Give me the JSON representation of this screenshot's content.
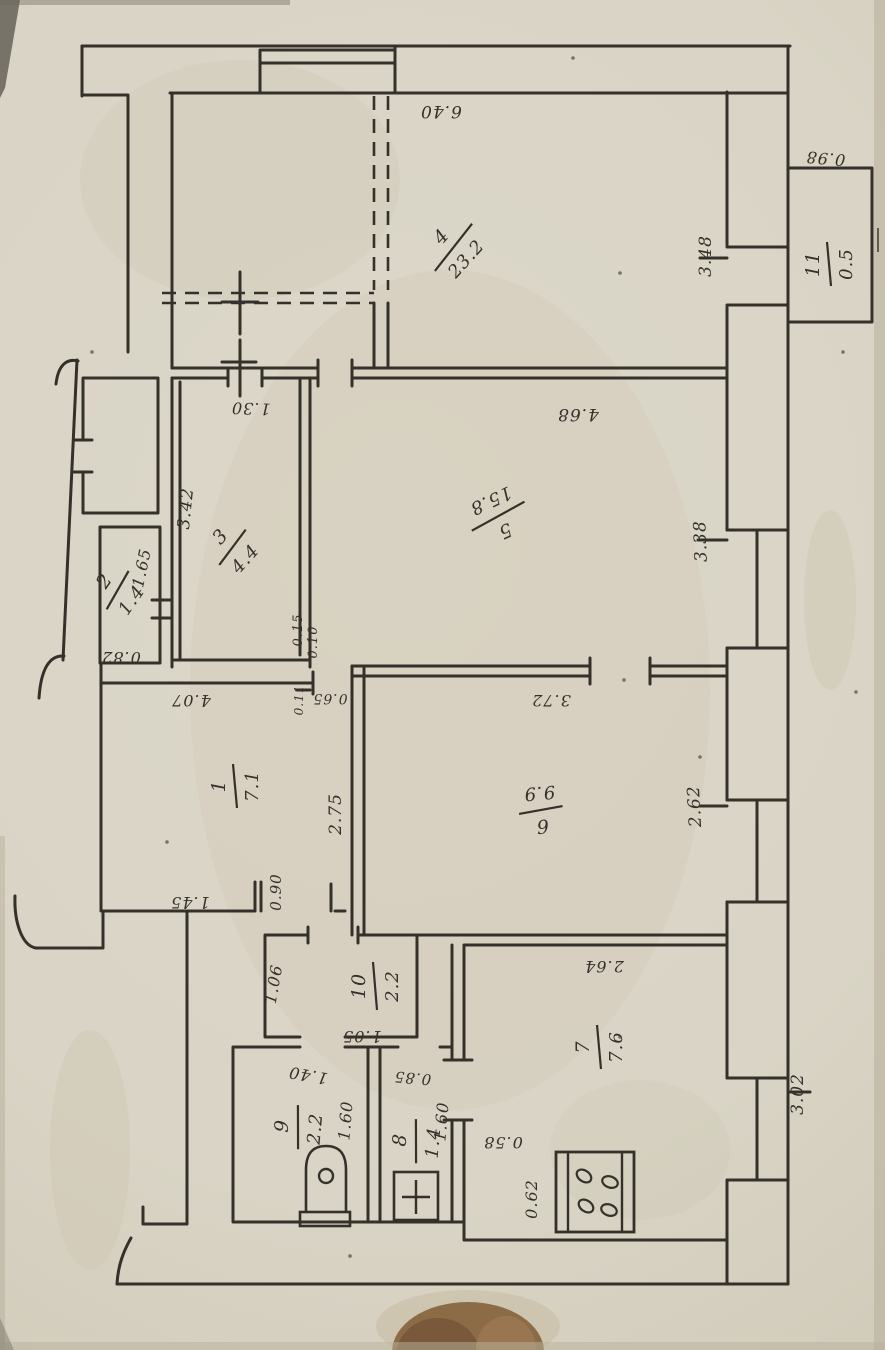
{
  "photo": {
    "kind": "scanned hand-drawn apartment floor plan, rotated",
    "language": "numeric labels only"
  },
  "colors": {
    "paper": "#d9d4c5",
    "paper_edge": "#c6bfab",
    "ink": "#34312b",
    "stain": "#cfc8b4",
    "finger_dark": "#77573a",
    "finger_mid": "#8c6c46",
    "finger_light": "#9a7850"
  },
  "rooms": [
    {
      "number": "1",
      "area": "7.1",
      "x": 233,
      "y": 786,
      "rot": -90,
      "len": 22
    },
    {
      "number": "2",
      "area": "1.4",
      "x": 116,
      "y": 589,
      "rot": -55,
      "len": 22
    },
    {
      "number": "3",
      "area": "4.4",
      "x": 231,
      "y": 546,
      "rot": -48,
      "len": 22
    },
    {
      "number": "4",
      "area": "23.2",
      "x": 452,
      "y": 246,
      "rot": -48,
      "len": 30
    },
    {
      "number": "5",
      "area": "15.8",
      "x": 499,
      "y": 518,
      "rot": 155,
      "len": 30
    },
    {
      "number": "6",
      "area": "9.9",
      "x": 541,
      "y": 812,
      "rot": 175,
      "len": 22
    },
    {
      "number": "7",
      "area": "7.6",
      "x": 597,
      "y": 1047,
      "rot": -90,
      "len": 22
    },
    {
      "number": "8",
      "area": "1.4",
      "x": 414,
      "y": 1141,
      "rot": -85,
      "len": 22
    },
    {
      "number": "9",
      "area": "2.2",
      "x": 296,
      "y": 1127,
      "rot": -85,
      "len": 22
    },
    {
      "number": "10",
      "area": "2.2",
      "x": 373,
      "y": 986,
      "rot": -90,
      "len": 24
    },
    {
      "number": "11",
      "area": "0.5",
      "x": 827,
      "y": 264,
      "rot": -90,
      "len": 22
    }
  ],
  "dimensions": [
    {
      "value": "6.40",
      "x": 441,
      "y": 106,
      "rot": 180,
      "size": 17
    },
    {
      "value": "0.98",
      "x": 826,
      "y": 153,
      "rot": 185,
      "size": 16
    },
    {
      "value": "3.48",
      "x": 711,
      "y": 256,
      "rot": -90,
      "size": 17
    },
    {
      "value": "1.30",
      "x": 251,
      "y": 403,
      "rot": 182,
      "size": 16
    },
    {
      "value": "4.68",
      "x": 578,
      "y": 409,
      "rot": 180,
      "size": 17
    },
    {
      "value": "3.42",
      "x": 191,
      "y": 509,
      "rot": -84,
      "size": 17
    },
    {
      "value": "3.38",
      "x": 706,
      "y": 541,
      "rot": -92,
      "size": 17
    },
    {
      "value": "1.65",
      "x": 147,
      "y": 569,
      "rot": -78,
      "size": 16
    },
    {
      "value": "0.82",
      "x": 121,
      "y": 652,
      "rot": 180,
      "size": 16
    },
    {
      "value": "4.07",
      "x": 191,
      "y": 695,
      "rot": 180,
      "size": 16
    },
    {
      "value": "0.15",
      "x": 302,
      "y": 630,
      "rot": -90,
      "size": 13
    },
    {
      "value": "0.10",
      "x": 317,
      "y": 642,
      "rot": -90,
      "size": 13
    },
    {
      "value": "0.65",
      "x": 330,
      "y": 694,
      "rot": 180,
      "size": 14
    },
    {
      "value": "0.11",
      "x": 303,
      "y": 700,
      "rot": -90,
      "size": 12
    },
    {
      "value": "3.72",
      "x": 551,
      "y": 695,
      "rot": 180,
      "size": 16
    },
    {
      "value": "2.75",
      "x": 341,
      "y": 814,
      "rot": -90,
      "size": 17
    },
    {
      "value": "2.62",
      "x": 700,
      "y": 806,
      "rot": -93,
      "size": 17
    },
    {
      "value": "1.45",
      "x": 190,
      "y": 897,
      "rot": 180,
      "size": 16
    },
    {
      "value": "0.90",
      "x": 281,
      "y": 892,
      "rot": -90,
      "size": 15
    },
    {
      "value": "1.06",
      "x": 279,
      "y": 985,
      "rot": -80,
      "size": 16
    },
    {
      "value": "1.05",
      "x": 362,
      "y": 1031,
      "rot": 180,
      "size": 16
    },
    {
      "value": "1.40",
      "x": 309,
      "y": 1070,
      "rot": 190,
      "size": 16
    },
    {
      "value": "1.60",
      "x": 351,
      "y": 1121,
      "rot": -85,
      "size": 16
    },
    {
      "value": "0.85",
      "x": 413,
      "y": 1073,
      "rot": 185,
      "size": 15
    },
    {
      "value": "1.60",
      "x": 447,
      "y": 1122,
      "rot": -85,
      "size": 16
    },
    {
      "value": "0.58",
      "x": 503,
      "y": 1137,
      "rot": 180,
      "size": 16
    },
    {
      "value": "0.62",
      "x": 537,
      "y": 1199,
      "rot": -90,
      "size": 16
    },
    {
      "value": "2.64",
      "x": 604,
      "y": 961,
      "rot": 180,
      "size": 16
    },
    {
      "value": "3.02",
      "x": 803,
      "y": 1094,
      "rot": -90,
      "size": 17
    }
  ],
  "fixtures": [
    "bathtub",
    "toilet",
    "stove-4-burner"
  ]
}
